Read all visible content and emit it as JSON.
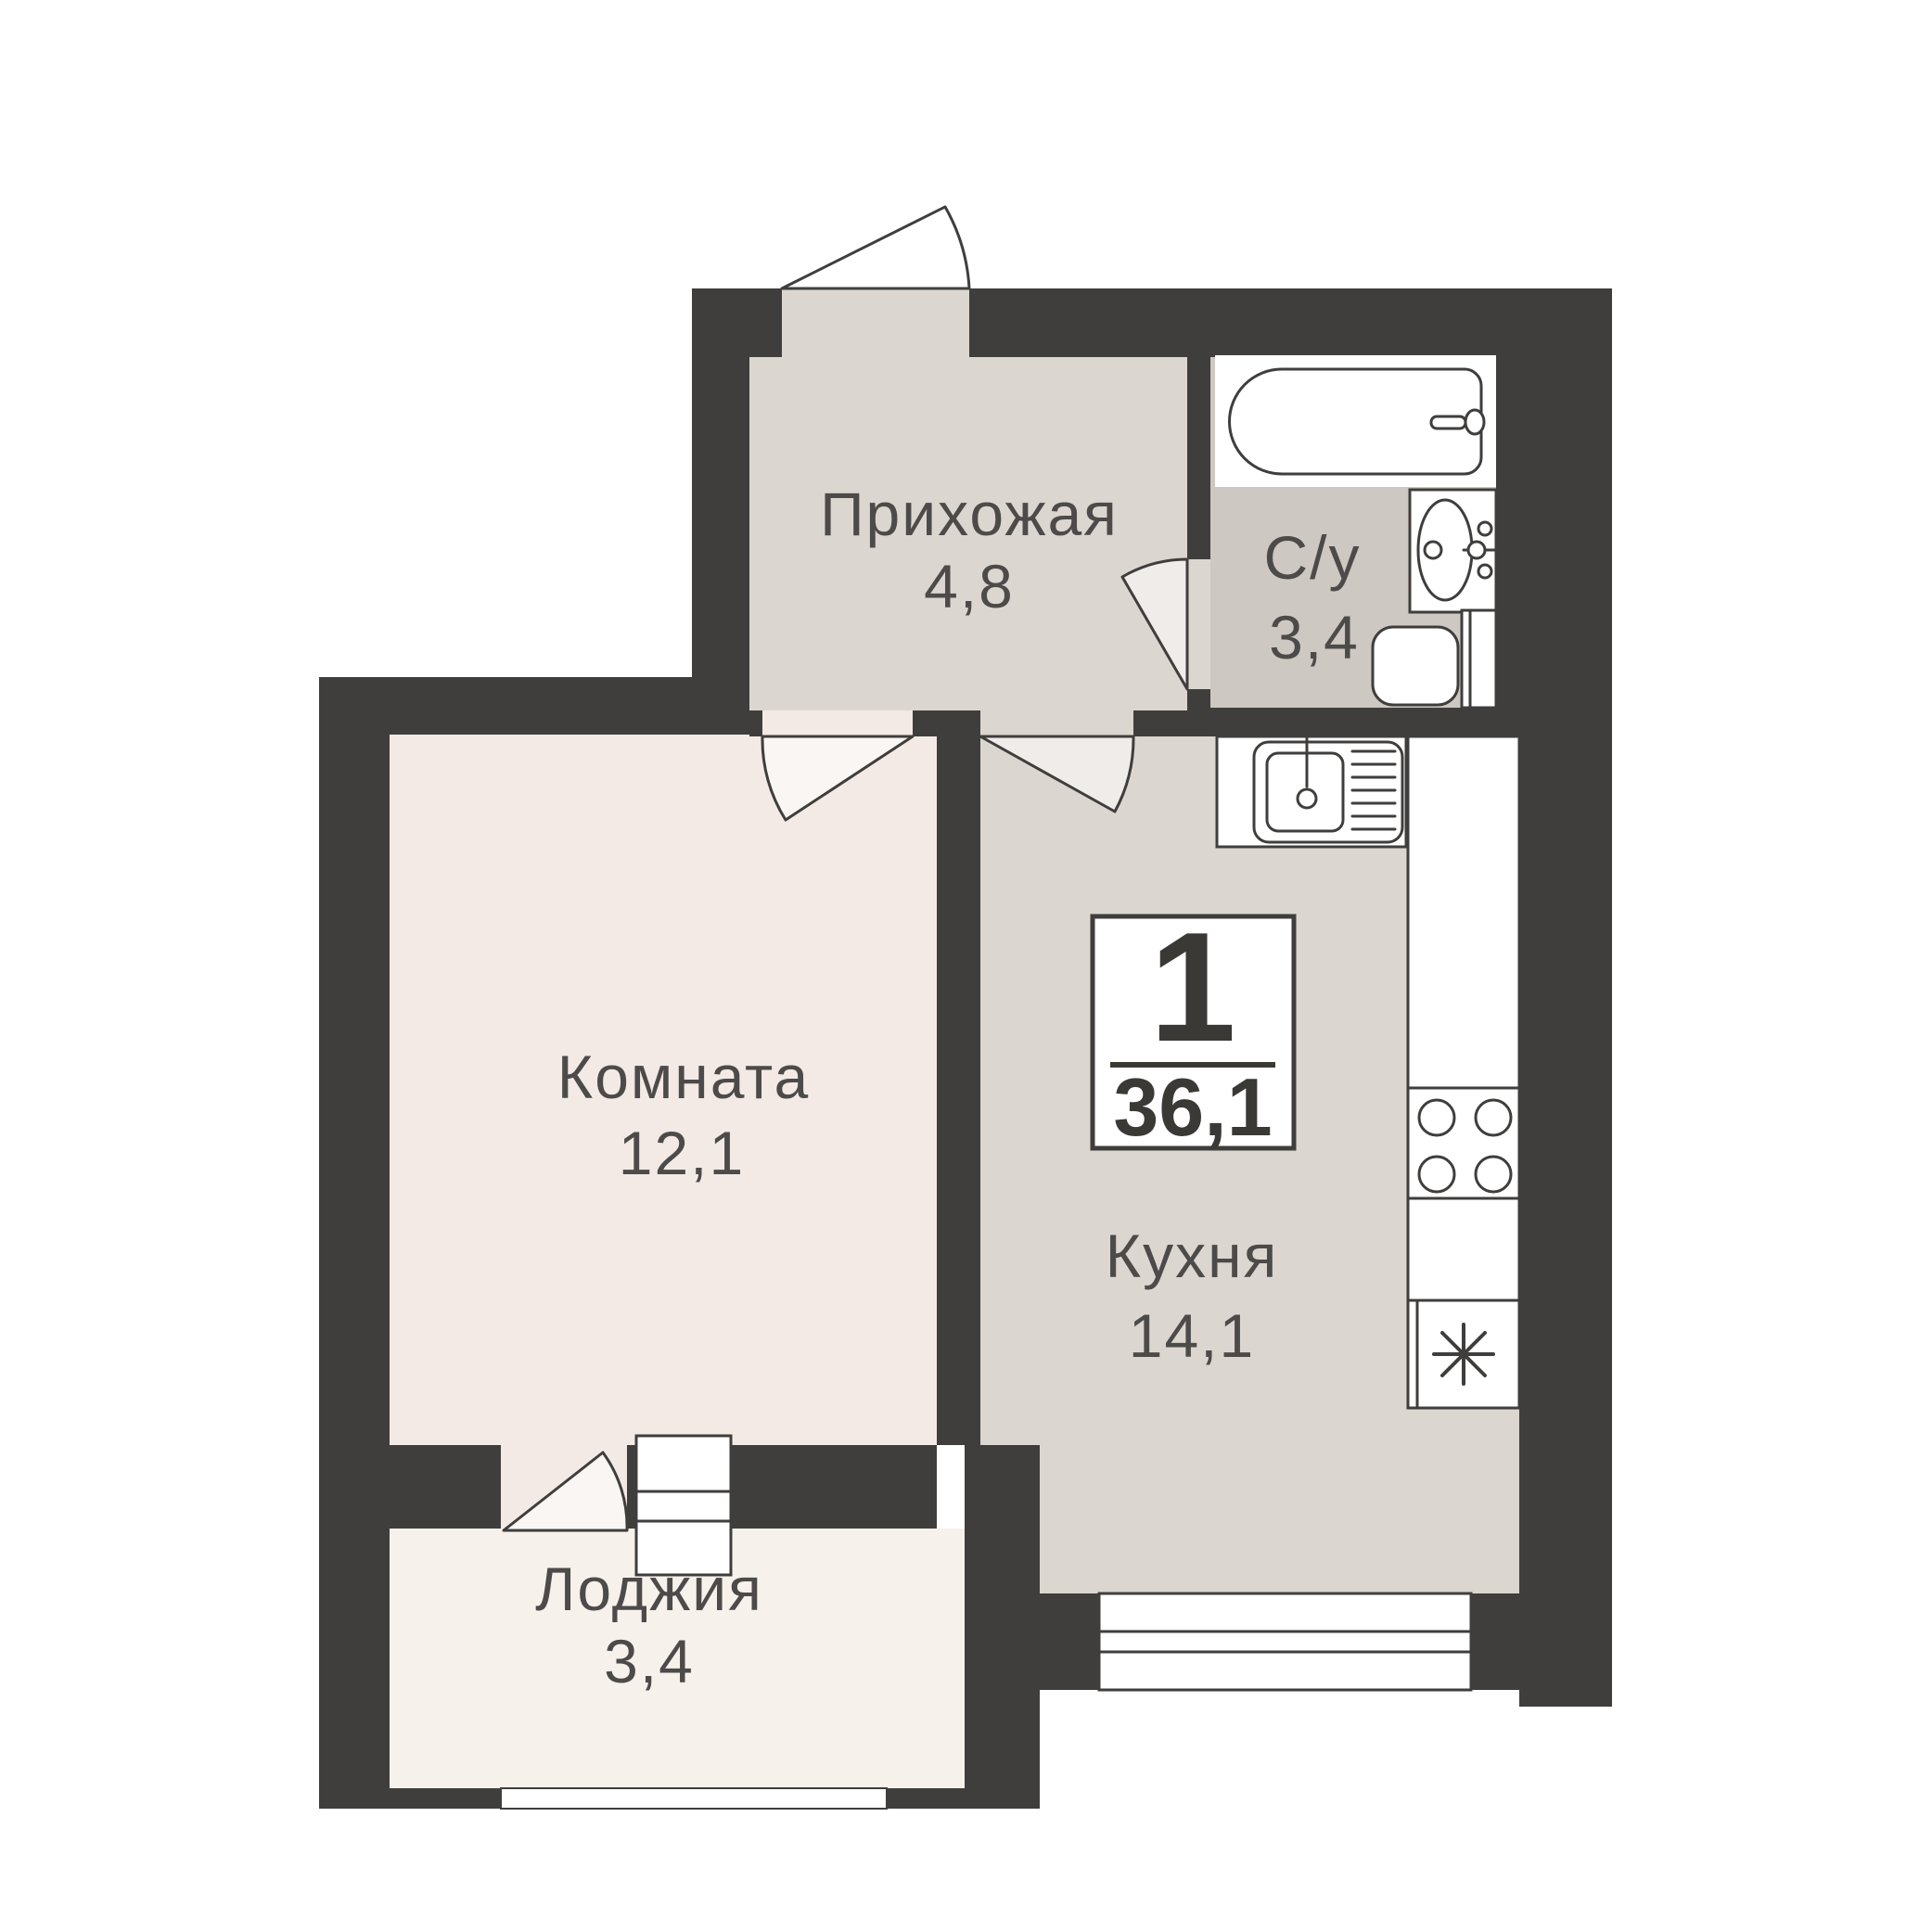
{
  "badge": {
    "rooms": "1",
    "total_area": "36,1"
  },
  "rooms": {
    "hallway": {
      "label": "Прихожая",
      "area": "4,8"
    },
    "bathroom": {
      "label": "С/у",
      "area": "3,4"
    },
    "living": {
      "label": "Комната",
      "area": "12,1"
    },
    "kitchen": {
      "label": "Кухня",
      "area": "14,1"
    },
    "loggia": {
      "label": "Лоджия",
      "area": "3,4"
    }
  },
  "colors": {
    "background": "#ffffff",
    "wall": "#3f3e3c",
    "hallway_floor": "#dcd6d0",
    "kitchen_floor": "#dcd6d0",
    "bathroom_floor": "#cdc8c2",
    "room_floor": "#f3eae5",
    "loggia_floor": "#f7f1ec",
    "fixture_fill": "#ffffff",
    "outline": "#3f3e3c",
    "label_text": "#4d4b49",
    "badge_text": "#3a3936"
  }
}
